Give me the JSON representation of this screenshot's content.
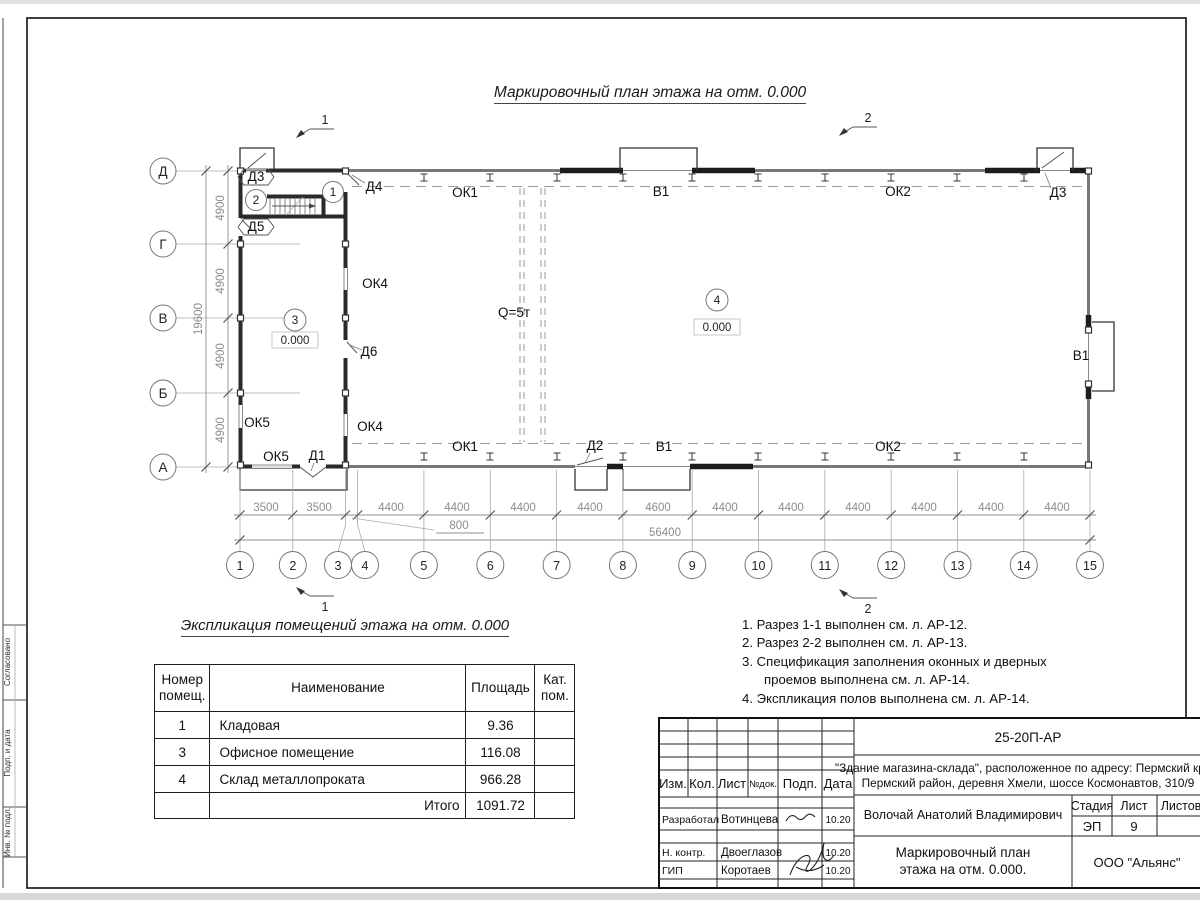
{
  "sheet": {
    "title": "Маркировочный план этажа на отм. 0.000"
  },
  "sections": {
    "s1": "1",
    "s2": "2"
  },
  "plan": {
    "axis_letters": [
      "Д",
      "Г",
      "В",
      "Б",
      "А"
    ],
    "left_dims": [
      "4900",
      "4900",
      "4900",
      "4900"
    ],
    "left_total": "19600",
    "grid_numbers": [
      "1",
      "2",
      "3",
      "4",
      "5",
      "6",
      "7",
      "8",
      "9",
      "10",
      "11",
      "12",
      "13",
      "14",
      "15"
    ],
    "dims": [
      "3500",
      "3500",
      "4400",
      "4400",
      "4400",
      "4400",
      "4600",
      "4400",
      "4400",
      "4400",
      "4400",
      "4400",
      "4400"
    ],
    "dim_800": "800",
    "total": "56400",
    "labels": {
      "d3_left": "Д3",
      "d4": "Д4",
      "d5": "Д5",
      "d6": "Д6",
      "ok4_upper": "ОК4",
      "ok4_lower": "ОК4",
      "ok5_upper": "ОК5",
      "ok5_lower": "ОК5",
      "d1": "Д1",
      "d2": "Д2",
      "ok1_top": "ОК1",
      "ok1_bottom": "ОК1",
      "v1_top": "В1",
      "v1_bottom": "В1",
      "v1_right": "В1",
      "ok2_top": "ОК2",
      "ok2_bottom": "ОК2",
      "d3_right": "Д3",
      "crane": "Q=5т",
      "room1": "1",
      "room2": "2",
      "room3": "3",
      "room4": "4",
      "level3": "0.000",
      "level4": "0.000"
    }
  },
  "explication": {
    "title": "Экспликация помещений этажа на отм. 0.000",
    "headers": [
      "Номер помещ.",
      "Наименование",
      "Площадь",
      "Кат. пом."
    ],
    "rows": [
      {
        "num": "1",
        "name": "Кладовая",
        "area": "9.36",
        "cat": ""
      },
      {
        "num": "3",
        "name": "Офисное помещение",
        "area": "116.08",
        "cat": ""
      },
      {
        "num": "4",
        "name": "Склад металлопроката",
        "area": "966.28",
        "cat": ""
      }
    ],
    "total_label": "Итого",
    "total_value": "1091.72"
  },
  "notes": {
    "lines": [
      "1. Разрез 1-1 выполнен см. л. АР-12.",
      "2. Разрез 2-2 выполнен см. л. АР-13.",
      "3. Спецификация заполнения оконных и дверных",
      "проемов выполнена см. л. АР-14.",
      "4. Экспликация полов выполнена см. л. АР-14."
    ]
  },
  "titleblock": {
    "doc_number": "25-20П-АР",
    "object_line1": "\"Здание магазина-склада\", расположенное по адресу: Пермский край,",
    "object_line2": "Пермский район, деревня Хмели, шоссе Космонавтов, 310/9",
    "col_izm": "Изм.",
    "col_kol": "Кол.",
    "col_list": "Лист",
    "col_ndoc": "№док.",
    "col_podp": "Подп.",
    "col_data": "Дата",
    "rows": [
      {
        "role": "Разработал",
        "name": "Вотинцева",
        "date": "10.20"
      },
      {
        "role": "Н. контр.",
        "name": "Двоеглазов",
        "date": "10.20"
      },
      {
        "role": "ГИП",
        "name": "Коротаев",
        "date": "10.20"
      }
    ],
    "approver": "Волочай Анатолий Владимирович",
    "stage_label": "Стадия",
    "sheet_label": "Лист",
    "sheets_label": "Листов",
    "stage": "ЭП",
    "sheet_num": "9",
    "title_line1": "Маркировочный план",
    "title_line2": "этажа на отм. 0.000.",
    "company": "ООО \"Альянс\""
  },
  "side_strip": {
    "labels": [
      "Согласовано",
      "Подп. и дата",
      "Инв. № подл."
    ]
  }
}
